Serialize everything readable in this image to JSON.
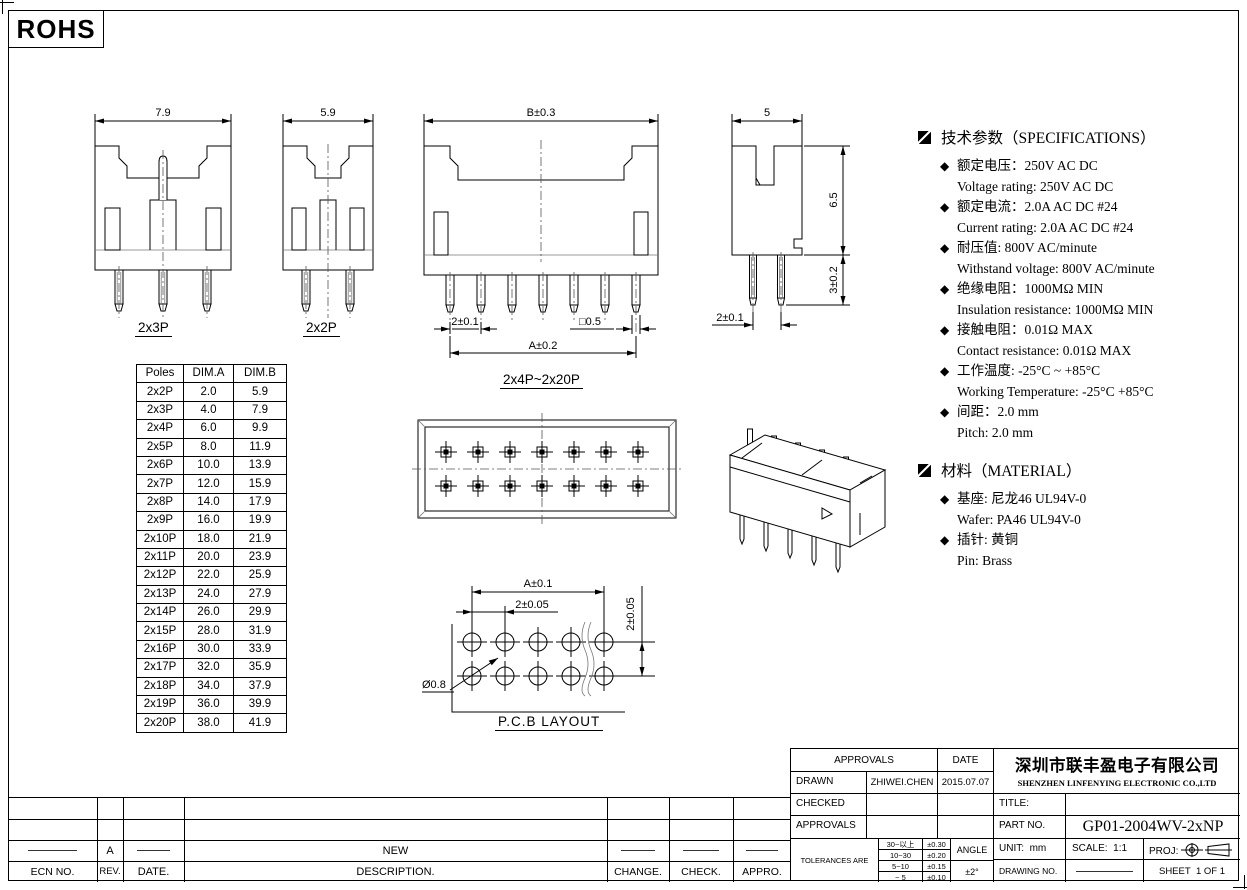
{
  "colors": {
    "background": "#ffffff",
    "line": "#000000",
    "light_line": "#888888"
  },
  "logo": "ROHS",
  "views": {
    "front_2x3p": {
      "label": "2x3P",
      "width_dim": "7.9"
    },
    "front_2x2p": {
      "label": "2x2P",
      "width_dim": "5.9"
    },
    "front_multi": {
      "label": "2x4P~2x20P",
      "top_dim": "B±0.3",
      "pitch_dim": "2±0.1",
      "pin_dim": "□0.5",
      "span_dim": "A±0.2"
    },
    "side": {
      "top_dim": "5",
      "height_dim": "6.5",
      "pin_len_dim": "3±0.2",
      "pitch_dim": "2±0.1"
    },
    "pcb": {
      "label": "P.C.B LAYOUT",
      "span_dim": "A±0.1",
      "pitch_dim": "2±0.05",
      "row_dim": "2±0.05",
      "hole_dim": "Ø0.8"
    }
  },
  "dim_table": {
    "headers": [
      "Poles",
      "DIM.A",
      "DIM.B"
    ],
    "rows": [
      [
        "2x2P",
        "2.0",
        "5.9"
      ],
      [
        "2x3P",
        "4.0",
        "7.9"
      ],
      [
        "2x4P",
        "6.0",
        "9.9"
      ],
      [
        "2x5P",
        "8.0",
        "11.9"
      ],
      [
        "2x6P",
        "10.0",
        "13.9"
      ],
      [
        "2x7P",
        "12.0",
        "15.9"
      ],
      [
        "2x8P",
        "14.0",
        "17.9"
      ],
      [
        "2x9P",
        "16.0",
        "19.9"
      ],
      [
        "2x10P",
        "18.0",
        "21.9"
      ],
      [
        "2x11P",
        "20.0",
        "23.9"
      ],
      [
        "2x12P",
        "22.0",
        "25.9"
      ],
      [
        "2x13P",
        "24.0",
        "27.9"
      ],
      [
        "2x14P",
        "26.0",
        "29.9"
      ],
      [
        "2x15P",
        "28.0",
        "31.9"
      ],
      [
        "2x16P",
        "30.0",
        "33.9"
      ],
      [
        "2x17P",
        "32.0",
        "35.9"
      ],
      [
        "2x18P",
        "34.0",
        "37.9"
      ],
      [
        "2x19P",
        "36.0",
        "39.9"
      ],
      [
        "2x20P",
        "38.0",
        "41.9"
      ]
    ]
  },
  "specs": {
    "title": "技术参数（SPECIFICATIONS）",
    "items": [
      {
        "cn": "额定电压：250V AC DC",
        "en": "Voltage rating: 250V AC DC"
      },
      {
        "cn": "额定电流：2.0A AC DC  #24",
        "en": "Current rating: 2.0A  AC DC  #24"
      },
      {
        "cn": "耐压值: 800V AC/minute",
        "en": "Withstand voltage: 800V AC/minute"
      },
      {
        "cn": "绝缘电阻：1000MΩ  MIN",
        "en": "Insulation resistance: 1000MΩ  MIN"
      },
      {
        "cn": "接触电阻：0.01Ω  MAX",
        "en": "Contact resistance:  0.01Ω  MAX"
      },
      {
        "cn": "工作温度: -25°C ~ +85°C",
        "en": "Working Temperature: -25°C  +85°C"
      },
      {
        "cn": "间距：2.0 mm",
        "en": "Pitch: 2.0 mm"
      }
    ]
  },
  "material": {
    "title": "材料（MATERIAL）",
    "items": [
      {
        "cn": "基座: 尼龙46 UL94V-0",
        "en": "Wafer:  PA46 UL94V-0"
      },
      {
        "cn": "插针: 黄铜",
        "en": "Pin: Brass"
      }
    ]
  },
  "title_block": {
    "approvals_header": "APPROVALS",
    "date_header": "DATE",
    "drawn_label": "DRAWN",
    "drawn_name": "ZHIWEI.CHEN",
    "drawn_date": "2015.07.07",
    "checked_label": "CHECKED",
    "approvals_label": "APPROVALS",
    "tolerances_label": "TOLERANCES ARE",
    "tolerance_rows": [
      [
        "30~以上",
        "±0.30"
      ],
      [
        "10~30",
        "±0.20"
      ],
      [
        "5~10",
        "±0.15"
      ],
      [
        "~ 5",
        "±0.10"
      ]
    ],
    "angle_label": "ANGLE",
    "angle_value": "±2°",
    "company_cn": "深圳市联丰盈电子有限公司",
    "company_en": "SHENZHEN LINFENYING ELECTRONIC CO.,LTD",
    "title_label": "TITLE:",
    "part_no_label": "PART NO.",
    "part_no": "GP01-2004WV-2xNP",
    "unit_label": "UNIT:",
    "unit_value": "mm",
    "scale_label": "SCALE:",
    "scale_value": "1:1",
    "proj_label": "PROJ:",
    "drawing_no_label": "DRAWING NO.",
    "sheet_label": "SHEET",
    "sheet_value": "1 OF 1"
  },
  "revision_table": {
    "headers": [
      "ECN NO.",
      "REV.",
      "DATE.",
      "DESCRIPTION.",
      "CHANGE.",
      "CHECK.",
      "APPRO."
    ],
    "entry_rev": "A",
    "entry_description": "NEW"
  }
}
